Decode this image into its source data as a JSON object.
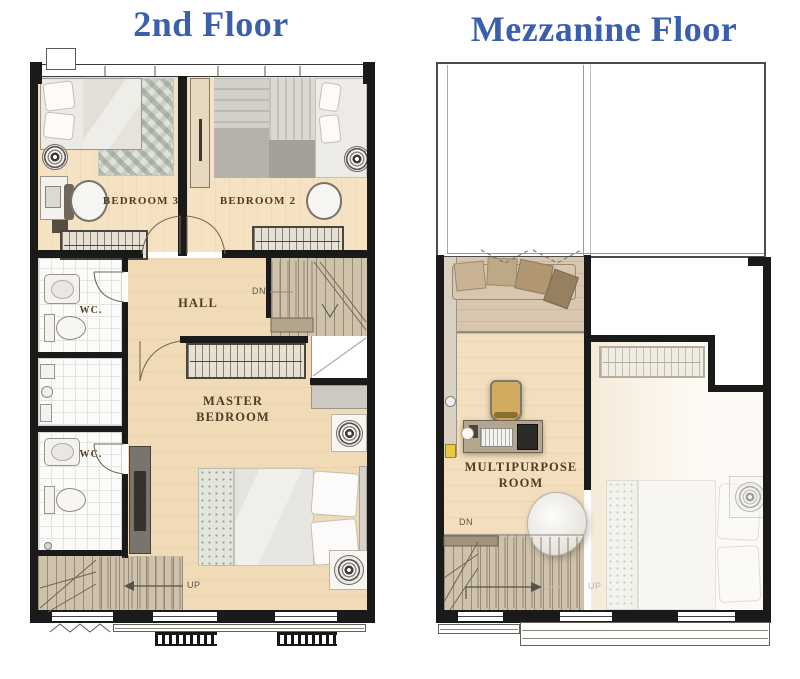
{
  "titles": {
    "floor2": "2nd Floor",
    "mezzanine": "Mezzanine Floor"
  },
  "colors": {
    "title": "#3a5fad",
    "wall": "#1a1a1a",
    "label": "#503c26"
  },
  "floor2": {
    "labels": {
      "bedroom3": "BEDROOM 3",
      "bedroom2": "BEDROOM 2",
      "hall": "HALL",
      "wc_upper": "WC.",
      "wc_lower": "WC.",
      "master_line1": "MASTER",
      "master_line2": "BEDROOM",
      "stairs_down": "DN",
      "stairs_up": "UP"
    }
  },
  "mezzanine": {
    "labels": {
      "multipurpose_line1": "MULTIPURPOSE",
      "multipurpose_line2": "ROOM",
      "stairs_down": "DN",
      "stairs_up_ghost": "UP"
    }
  }
}
